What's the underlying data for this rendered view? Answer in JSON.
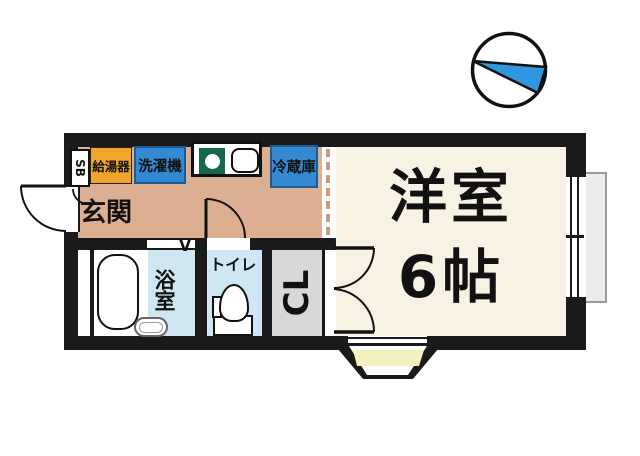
{
  "plan": {
    "rooms": {
      "main": {
        "name": "洋室",
        "size": "6帖"
      },
      "entrance": {
        "label": "玄関"
      },
      "bathroom": {
        "label": "浴室"
      },
      "toilet": {
        "label": "トイレ"
      },
      "closet": {
        "label": "CL"
      },
      "shoe_box": {
        "label": "SB"
      }
    },
    "equipment": {
      "water_heater": {
        "label": "給湯器"
      },
      "washing_machine": {
        "label": "洗濯機"
      },
      "refrigerator": {
        "label": "冷蔵庫"
      }
    },
    "marks": {
      "bath_door": "V"
    },
    "colors": {
      "wall": "#1a1a1a",
      "kitchen_floor": "#dcae92",
      "main_room_floor": "#f8f2e4",
      "wet_room_floor": "#cfe7f2",
      "closet_floor": "#d8d8d8",
      "step_yellow": "#f5f0bf",
      "appliance_blue": "#3489d2",
      "water_heater_orange": "#f2a52b",
      "burner_green": "#17674b",
      "compass_needle_blue": "#2e97e0"
    }
  }
}
